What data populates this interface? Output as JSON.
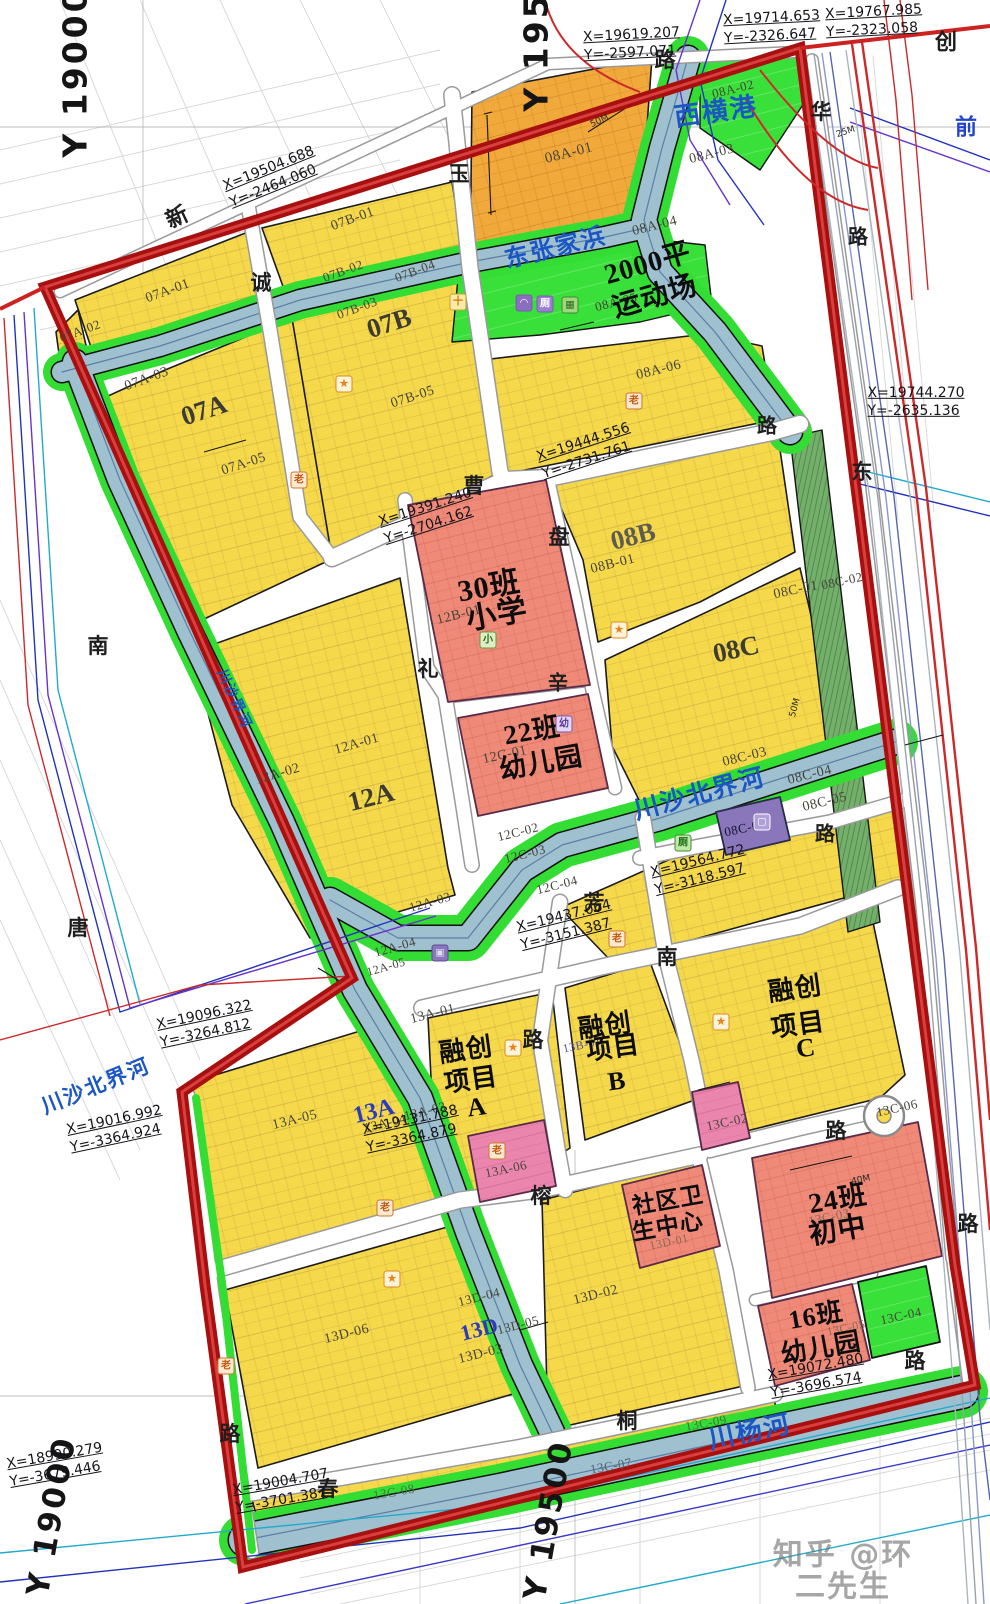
{
  "meta": {
    "width": 990,
    "height": 1604,
    "watermark": {
      "t": "知乎 @环二先生",
      "x": 843,
      "y": 1571,
      "s": 30
    }
  },
  "colors": {
    "boundary_red": "#a80f0f",
    "boundary_inner": "#d84040",
    "parcel_yellow": "#f6d84b",
    "parcel_orange": "#f2a93b",
    "green": "#33dd33",
    "green_dark": "#74b06b",
    "river_blue": "#9fc0cf",
    "school_pink": "#ef8a78",
    "magenta": "#ea86ad",
    "purple": "#8a77bb",
    "water_text": "#1a56c4"
  },
  "grid_labels": [
    {
      "t": "Y  19000",
      "x": 76,
      "y": 72,
      "s": 33,
      "r": -90
    },
    {
      "t": "Y  19500",
      "x": 537,
      "y": 26,
      "s": 33,
      "r": -90
    },
    {
      "t": "Y  19500",
      "x": 549,
      "y": 1520,
      "s": 31,
      "r": -80
    },
    {
      "t": "Y  19000",
      "x": 52,
      "y": 1516,
      "s": 31,
      "r": -80
    }
  ],
  "road_labels": [
    {
      "t": "新",
      "x": 177,
      "y": 217,
      "s": 22,
      "r": -25
    },
    {
      "t": "路",
      "x": 665,
      "y": 60,
      "s": 21
    },
    {
      "t": "创",
      "x": 946,
      "y": 42,
      "s": 22
    },
    {
      "t": "华",
      "x": 821,
      "y": 112,
      "s": 21
    },
    {
      "t": "玉",
      "x": 459,
      "y": 174,
      "s": 21
    },
    {
      "t": "诚",
      "x": 261,
      "y": 283,
      "s": 21
    },
    {
      "t": "曹",
      "x": 474,
      "y": 486,
      "s": 21
    },
    {
      "t": "盘",
      "x": 559,
      "y": 537,
      "s": 21
    },
    {
      "t": "礼",
      "x": 428,
      "y": 669,
      "s": 21
    },
    {
      "t": "辛",
      "x": 558,
      "y": 684,
      "s": 20
    },
    {
      "t": "芳",
      "x": 594,
      "y": 903,
      "s": 21
    },
    {
      "t": "南",
      "x": 667,
      "y": 957,
      "s": 21
    },
    {
      "t": "路",
      "x": 533,
      "y": 1040,
      "s": 21
    },
    {
      "t": "榕",
      "x": 541,
      "y": 1196,
      "s": 21
    },
    {
      "t": "桐",
      "x": 627,
      "y": 1421,
      "s": 21
    },
    {
      "t": "春",
      "x": 328,
      "y": 1489,
      "s": 21
    },
    {
      "t": "路",
      "x": 836,
      "y": 1131,
      "s": 21
    },
    {
      "t": "路",
      "x": 825,
      "y": 835,
      "s": 20
    },
    {
      "t": "路",
      "x": 767,
      "y": 427,
      "s": 20
    },
    {
      "t": "路",
      "x": 858,
      "y": 238,
      "s": 20
    },
    {
      "t": "东",
      "x": 862,
      "y": 472,
      "s": 21
    },
    {
      "t": "南",
      "x": 98,
      "y": 646,
      "s": 21
    },
    {
      "t": "唐",
      "x": 78,
      "y": 928,
      "s": 21
    },
    {
      "t": "路",
      "x": 230,
      "y": 1434,
      "s": 21
    },
    {
      "t": "路",
      "x": 968,
      "y": 1224,
      "s": 21
    },
    {
      "t": "路",
      "x": 915,
      "y": 1361,
      "s": 21
    },
    {
      "t": "前",
      "x": 966,
      "y": 127,
      "s": 22,
      "c": "#2244cc"
    }
  ],
  "water_labels": [
    {
      "t": "西横港",
      "x": 716,
      "y": 112,
      "s": 26,
      "r": -8
    },
    {
      "t": "东张家浜",
      "x": 556,
      "y": 249,
      "s": 24,
      "r": -14
    },
    {
      "t": "川沙北界河",
      "x": 700,
      "y": 795,
      "s": 25,
      "r": -15
    },
    {
      "t": "川沙北界河",
      "x": 96,
      "y": 1086,
      "s": 21,
      "r": -22
    },
    {
      "t": "川杨河",
      "x": 750,
      "y": 1432,
      "s": 26,
      "r": -12
    },
    {
      "t": "川沙界河",
      "x": 233,
      "y": 700,
      "s": 14,
      "r": 65
    }
  ],
  "zone_labels": [
    {
      "t": "07A",
      "x": 204,
      "y": 410,
      "s": 27,
      "r": -18
    },
    {
      "t": "07B",
      "x": 389,
      "y": 323,
      "s": 27,
      "r": -18
    },
    {
      "t": "12A",
      "x": 371,
      "y": 797,
      "s": 27,
      "r": -14
    },
    {
      "t": "08B",
      "x": 633,
      "y": 536,
      "s": 27,
      "r": -14,
      "c": "#5c5c50"
    },
    {
      "t": "08C",
      "x": 736,
      "y": 649,
      "s": 27,
      "r": -12
    },
    {
      "t": "13A",
      "x": 374,
      "y": 1112,
      "s": 24,
      "r": -14,
      "c": "#2b3bbb"
    },
    {
      "t": "13D",
      "x": 479,
      "y": 1329,
      "s": 22,
      "r": -14,
      "c": "#2b3bbb"
    }
  ],
  "parcel_labels": [
    {
      "t": "07A-01",
      "x": 168,
      "y": 292,
      "s": 14,
      "r": -20
    },
    {
      "t": "07A-02",
      "x": 80,
      "y": 331,
      "s": 13,
      "r": -20
    },
    {
      "t": "07A-03",
      "x": 147,
      "y": 380,
      "s": 14,
      "r": -20
    },
    {
      "t": "07A-05",
      "x": 244,
      "y": 465,
      "s": 14,
      "r": -18
    },
    {
      "t": "07B-01",
      "x": 353,
      "y": 220,
      "s": 14,
      "r": -20
    },
    {
      "t": "07B-02",
      "x": 343,
      "y": 271,
      "s": 13,
      "r": -20
    },
    {
      "t": "07B-03",
      "x": 357,
      "y": 308,
      "s": 13,
      "r": -20
    },
    {
      "t": "07B-04",
      "x": 415,
      "y": 271,
      "s": 13,
      "r": -20
    },
    {
      "t": "07B-05",
      "x": 413,
      "y": 398,
      "s": 14,
      "r": -18
    },
    {
      "t": "08A-01",
      "x": 569,
      "y": 154,
      "s": 15,
      "r": -14
    },
    {
      "t": "08A-02",
      "x": 733,
      "y": 89,
      "s": 13,
      "r": -14
    },
    {
      "t": "08A-03",
      "x": 712,
      "y": 155,
      "s": 14,
      "r": -14
    },
    {
      "t": "08A-04",
      "x": 655,
      "y": 227,
      "s": 14,
      "r": -14
    },
    {
      "t": "08A-05",
      "x": 616,
      "y": 302,
      "s": 13,
      "r": -14
    },
    {
      "t": "08A-06",
      "x": 659,
      "y": 371,
      "s": 14,
      "r": -14
    },
    {
      "t": "08B-01",
      "x": 613,
      "y": 565,
      "s": 14,
      "r": -14
    },
    {
      "t": "08C-01",
      "x": 796,
      "y": 591,
      "s": 14,
      "r": -12
    },
    {
      "t": "08C-02",
      "x": 842,
      "y": 581,
      "s": 13,
      "r": -12
    },
    {
      "t": "08C-03",
      "x": 745,
      "y": 758,
      "s": 14,
      "r": -14
    },
    {
      "t": "08C-04",
      "x": 810,
      "y": 776,
      "s": 14,
      "r": -14
    },
    {
      "t": "08C-05",
      "x": 825,
      "y": 803,
      "s": 14,
      "r": -14
    },
    {
      "t": "08C-06",
      "x": 745,
      "y": 828,
      "s": 13,
      "r": -12,
      "c": "#14142e"
    },
    {
      "t": "12B-01",
      "x": 459,
      "y": 616,
      "s": 14,
      "r": -14
    },
    {
      "t": "12C-01",
      "x": 505,
      "y": 756,
      "s": 14,
      "r": -12
    },
    {
      "t": "12C-02",
      "x": 518,
      "y": 832,
      "s": 13,
      "r": -14
    },
    {
      "t": "12C-03",
      "x": 525,
      "y": 854,
      "s": 13,
      "r": -14
    },
    {
      "t": "12C-04",
      "x": 557,
      "y": 885,
      "s": 13,
      "r": -14
    },
    {
      "t": "12A-01",
      "x": 357,
      "y": 745,
      "s": 14,
      "r": -16
    },
    {
      "t": "12A-02",
      "x": 278,
      "y": 775,
      "s": 14,
      "r": -16
    },
    {
      "t": "12A-03",
      "x": 430,
      "y": 902,
      "s": 13,
      "r": -16
    },
    {
      "t": "12A-04",
      "x": 395,
      "y": 947,
      "s": 13,
      "r": -16
    },
    {
      "t": "12A-05",
      "x": 386,
      "y": 967,
      "s": 12,
      "r": -16
    },
    {
      "t": "13A-01",
      "x": 433,
      "y": 1015,
      "s": 14,
      "r": -14
    },
    {
      "t": "13A-03",
      "x": 425,
      "y": 1111,
      "s": 13,
      "r": -14
    },
    {
      "t": "13A-04",
      "x": 385,
      "y": 1123,
      "s": 13,
      "r": -14
    },
    {
      "t": "13A-05",
      "x": 295,
      "y": 1121,
      "s": 14,
      "r": -14
    },
    {
      "t": "13A-06",
      "x": 506,
      "y": 1169,
      "s": 13,
      "r": -12
    },
    {
      "t": "13B-01",
      "x": 582,
      "y": 1045,
      "s": 12,
      "r": -12,
      "c": "#5555aa"
    },
    {
      "t": "13C-02",
      "x": 727,
      "y": 1122,
      "s": 13,
      "r": -12
    },
    {
      "t": "13C-03",
      "x": 829,
      "y": 1217,
      "s": 13,
      "r": -12,
      "c": "#8a6a55"
    },
    {
      "t": "13C-04",
      "x": 901,
      "y": 1316,
      "s": 13,
      "r": -12
    },
    {
      "t": "13C-05",
      "x": 846,
      "y": 1328,
      "s": 12,
      "r": -12,
      "c": "#8a6a55"
    },
    {
      "t": "13C-06",
      "x": 897,
      "y": 1108,
      "s": 13,
      "r": -12
    },
    {
      "t": "13C-07",
      "x": 611,
      "y": 1466,
      "s": 13,
      "r": -10,
      "c": "#55636e"
    },
    {
      "t": "13C-08",
      "x": 394,
      "y": 1492,
      "s": 13,
      "r": -10,
      "c": "#3f7a3f"
    },
    {
      "t": "13C-09",
      "x": 706,
      "y": 1423,
      "s": 13,
      "r": -10,
      "c": "#3f7a3f"
    },
    {
      "t": "13D-01",
      "x": 669,
      "y": 1242,
      "s": 12,
      "r": -12,
      "c": "#8a6a55"
    },
    {
      "t": "13D-02",
      "x": 596,
      "y": 1296,
      "s": 14,
      "r": -14
    },
    {
      "t": "13D-03",
      "x": 481,
      "y": 1355,
      "s": 14,
      "r": -14
    },
    {
      "t": "13D-04",
      "x": 479,
      "y": 1297,
      "s": 13,
      "r": -14
    },
    {
      "t": "13D-05",
      "x": 518,
      "y": 1325,
      "s": 13,
      "r": -14
    },
    {
      "t": "13D-06",
      "x": 347,
      "y": 1335,
      "s": 14,
      "r": -14
    }
  ],
  "facility_labels": [
    {
      "t": "30班",
      "x": 489,
      "y": 587,
      "s": 30,
      "r": -10
    },
    {
      "t": "小学",
      "x": 497,
      "y": 615,
      "s": 30,
      "r": -10
    },
    {
      "t": "22班",
      "x": 532,
      "y": 731,
      "s": 27,
      "r": -10
    },
    {
      "t": "幼儿园",
      "x": 541,
      "y": 763,
      "s": 27,
      "r": -10
    },
    {
      "t": "2000平",
      "x": 648,
      "y": 264,
      "s": 28,
      "r": -16
    },
    {
      "t": "运动场",
      "x": 655,
      "y": 297,
      "s": 28,
      "r": -16
    },
    {
      "t": "融创",
      "x": 466,
      "y": 1050,
      "s": 26,
      "r": -8
    },
    {
      "t": "项目",
      "x": 471,
      "y": 1080,
      "s": 26,
      "r": -8
    },
    {
      "t": "A",
      "x": 477,
      "y": 1107,
      "s": 26,
      "r": -8
    },
    {
      "t": "融创",
      "x": 605,
      "y": 1026,
      "s": 26,
      "r": -8
    },
    {
      "t": "项目",
      "x": 613,
      "y": 1048,
      "s": 26,
      "r": -8
    },
    {
      "t": "B",
      "x": 617,
      "y": 1081,
      "s": 26,
      "r": -8
    },
    {
      "t": "融创",
      "x": 795,
      "y": 989,
      "s": 26,
      "r": -8
    },
    {
      "t": "项目",
      "x": 798,
      "y": 1025,
      "s": 26,
      "r": -8
    },
    {
      "t": "C",
      "x": 806,
      "y": 1048,
      "s": 26,
      "r": -8
    },
    {
      "t": "24班",
      "x": 838,
      "y": 1200,
      "s": 28,
      "r": -10
    },
    {
      "t": "初中",
      "x": 838,
      "y": 1231,
      "s": 28,
      "r": -10
    },
    {
      "t": "16班",
      "x": 816,
      "y": 1316,
      "s": 26,
      "r": -10
    },
    {
      "t": "幼儿园",
      "x": 821,
      "y": 1348,
      "s": 26,
      "r": -10
    },
    {
      "t": "社区卫",
      "x": 668,
      "y": 1201,
      "s": 23,
      "r": -10
    },
    {
      "t": "生中心",
      "x": 668,
      "y": 1227,
      "s": 23,
      "r": -10
    }
  ],
  "coord_labels": [
    {
      "t": "X=19619.207\nY=-2597.071",
      "x": 632,
      "y": 44,
      "r": -3
    },
    {
      "t": "X=19714.653\nY=-2326.647",
      "x": 772,
      "y": 27,
      "r": -3
    },
    {
      "t": "X=19767.985\nY=-2323.058",
      "x": 874,
      "y": 21,
      "r": -3
    },
    {
      "t": "X=19504.688\nY=-2464.060",
      "x": 272,
      "y": 177,
      "r": -22
    },
    {
      "t": "X=19744.270\nY=-2635.136",
      "x": 916,
      "y": 402,
      "r": 0
    },
    {
      "t": "X=19444.556\nY=-2731.761",
      "x": 586,
      "y": 451,
      "r": -18
    },
    {
      "t": "X=19391.240\nY=-2704.162",
      "x": 428,
      "y": 516,
      "r": -18
    },
    {
      "t": "X=19564.772\nY=-3118.597",
      "x": 700,
      "y": 870,
      "r": -14
    },
    {
      "t": "X=19437.064\nY=-3151.387",
      "x": 566,
      "y": 925,
      "r": -14
    },
    {
      "t": "X=19131.788\nY=-3364.879",
      "x": 412,
      "y": 1129,
      "r": -12
    },
    {
      "t": "X=19016.992\nY=-3364.924",
      "x": 116,
      "y": 1129,
      "r": -12
    },
    {
      "t": "X=19096.322\nY=-3264.812",
      "x": 206,
      "y": 1024,
      "r": -12
    },
    {
      "t": "X=18990.279\nY=-3679.446",
      "x": 56,
      "y": 1465,
      "r": -10
    },
    {
      "t": "X=19072.480\nY=-3696.574",
      "x": 817,
      "y": 1376,
      "r": -10
    },
    {
      "t": "X=19004.707\nY=-3701.387",
      "x": 282,
      "y": 1491,
      "r": -10
    }
  ],
  "dim_labels": [
    {
      "t": "50M",
      "x": 600,
      "y": 122,
      "s": 9,
      "r": -25
    },
    {
      "t": "25M",
      "x": 846,
      "y": 133,
      "s": 9,
      "r": -18
    },
    {
      "t": "40M",
      "x": 861,
      "y": 1181,
      "s": 9,
      "r": -12
    },
    {
      "t": "50M",
      "x": 796,
      "y": 708,
      "s": 9,
      "r": -75
    }
  ],
  "icon_types": {
    "star": {
      "glyph": "★",
      "border": "#e08a1e",
      "bg": "#fdf3d8",
      "fg": "#e8821e"
    },
    "lao": {
      "glyph": "老",
      "border": "#d2742a",
      "bg": "#fbe9d2",
      "fg": "#c05a10"
    },
    "cross": {
      "glyph": "十",
      "border": "#c8a22c",
      "bg": "#faeaa8",
      "fg": "#d07800"
    },
    "xiao": {
      "glyph": "小",
      "border": "#6a9a3a",
      "bg": "#ddeec8",
      "fg": "#2f6a10"
    },
    "you": {
      "glyph": "幼",
      "border": "#7a5ab0",
      "bg": "#e4d8f4",
      "fg": "#5a3a9a"
    },
    "dome": {
      "glyph": "◠",
      "border": "#7a5ab0",
      "bg": "#8a6fc0",
      "fg": "#ffffff"
    },
    "ce": {
      "glyph": "厕",
      "border": "#7a5ab0",
      "bg": "#9a7fd0",
      "fg": "#ffffff"
    },
    "ce-green": {
      "glyph": "厕",
      "border": "#3a8a3a",
      "bg": "#bfe8a0",
      "fg": "#1a6a1a"
    },
    "greenbox": {
      "glyph": "▦",
      "border": "#3a8a3a",
      "bg": "#a0d878",
      "fg": "#2a6a2a"
    },
    "pbox": {
      "glyph": "▢",
      "border": "#ffffff",
      "bg": "#b09fd8",
      "fg": "#ffffff"
    },
    "pbox2": {
      "glyph": "▣",
      "border": "#5a4a9a",
      "bg": "#8a77bb",
      "fg": "#ddddee"
    }
  },
  "icons": [
    {
      "type": "star",
      "x": 344,
      "y": 384
    },
    {
      "type": "star",
      "x": 619,
      "y": 630
    },
    {
      "type": "star",
      "x": 513,
      "y": 1048
    },
    {
      "type": "star",
      "x": 721,
      "y": 1022
    },
    {
      "type": "star",
      "x": 392,
      "y": 1279
    },
    {
      "type": "lao",
      "x": 299,
      "y": 480
    },
    {
      "type": "lao",
      "x": 634,
      "y": 401
    },
    {
      "type": "lao",
      "x": 617,
      "y": 939
    },
    {
      "type": "lao",
      "x": 385,
      "y": 1208
    },
    {
      "type": "lao",
      "x": 226,
      "y": 1366
    },
    {
      "type": "lao",
      "x": 497,
      "y": 1151
    },
    {
      "type": "cross",
      "x": 458,
      "y": 302
    },
    {
      "type": "xiao",
      "x": 488,
      "y": 640
    },
    {
      "type": "you",
      "x": 564,
      "y": 724
    },
    {
      "type": "dome",
      "x": 524,
      "y": 303
    },
    {
      "type": "ce",
      "x": 545,
      "y": 304
    },
    {
      "type": "greenbox",
      "x": 570,
      "y": 305
    },
    {
      "type": "ce-green",
      "x": 683,
      "y": 843
    },
    {
      "type": "pbox",
      "x": 762,
      "y": 822
    },
    {
      "type": "pbox2",
      "x": 440,
      "y": 953
    }
  ]
}
